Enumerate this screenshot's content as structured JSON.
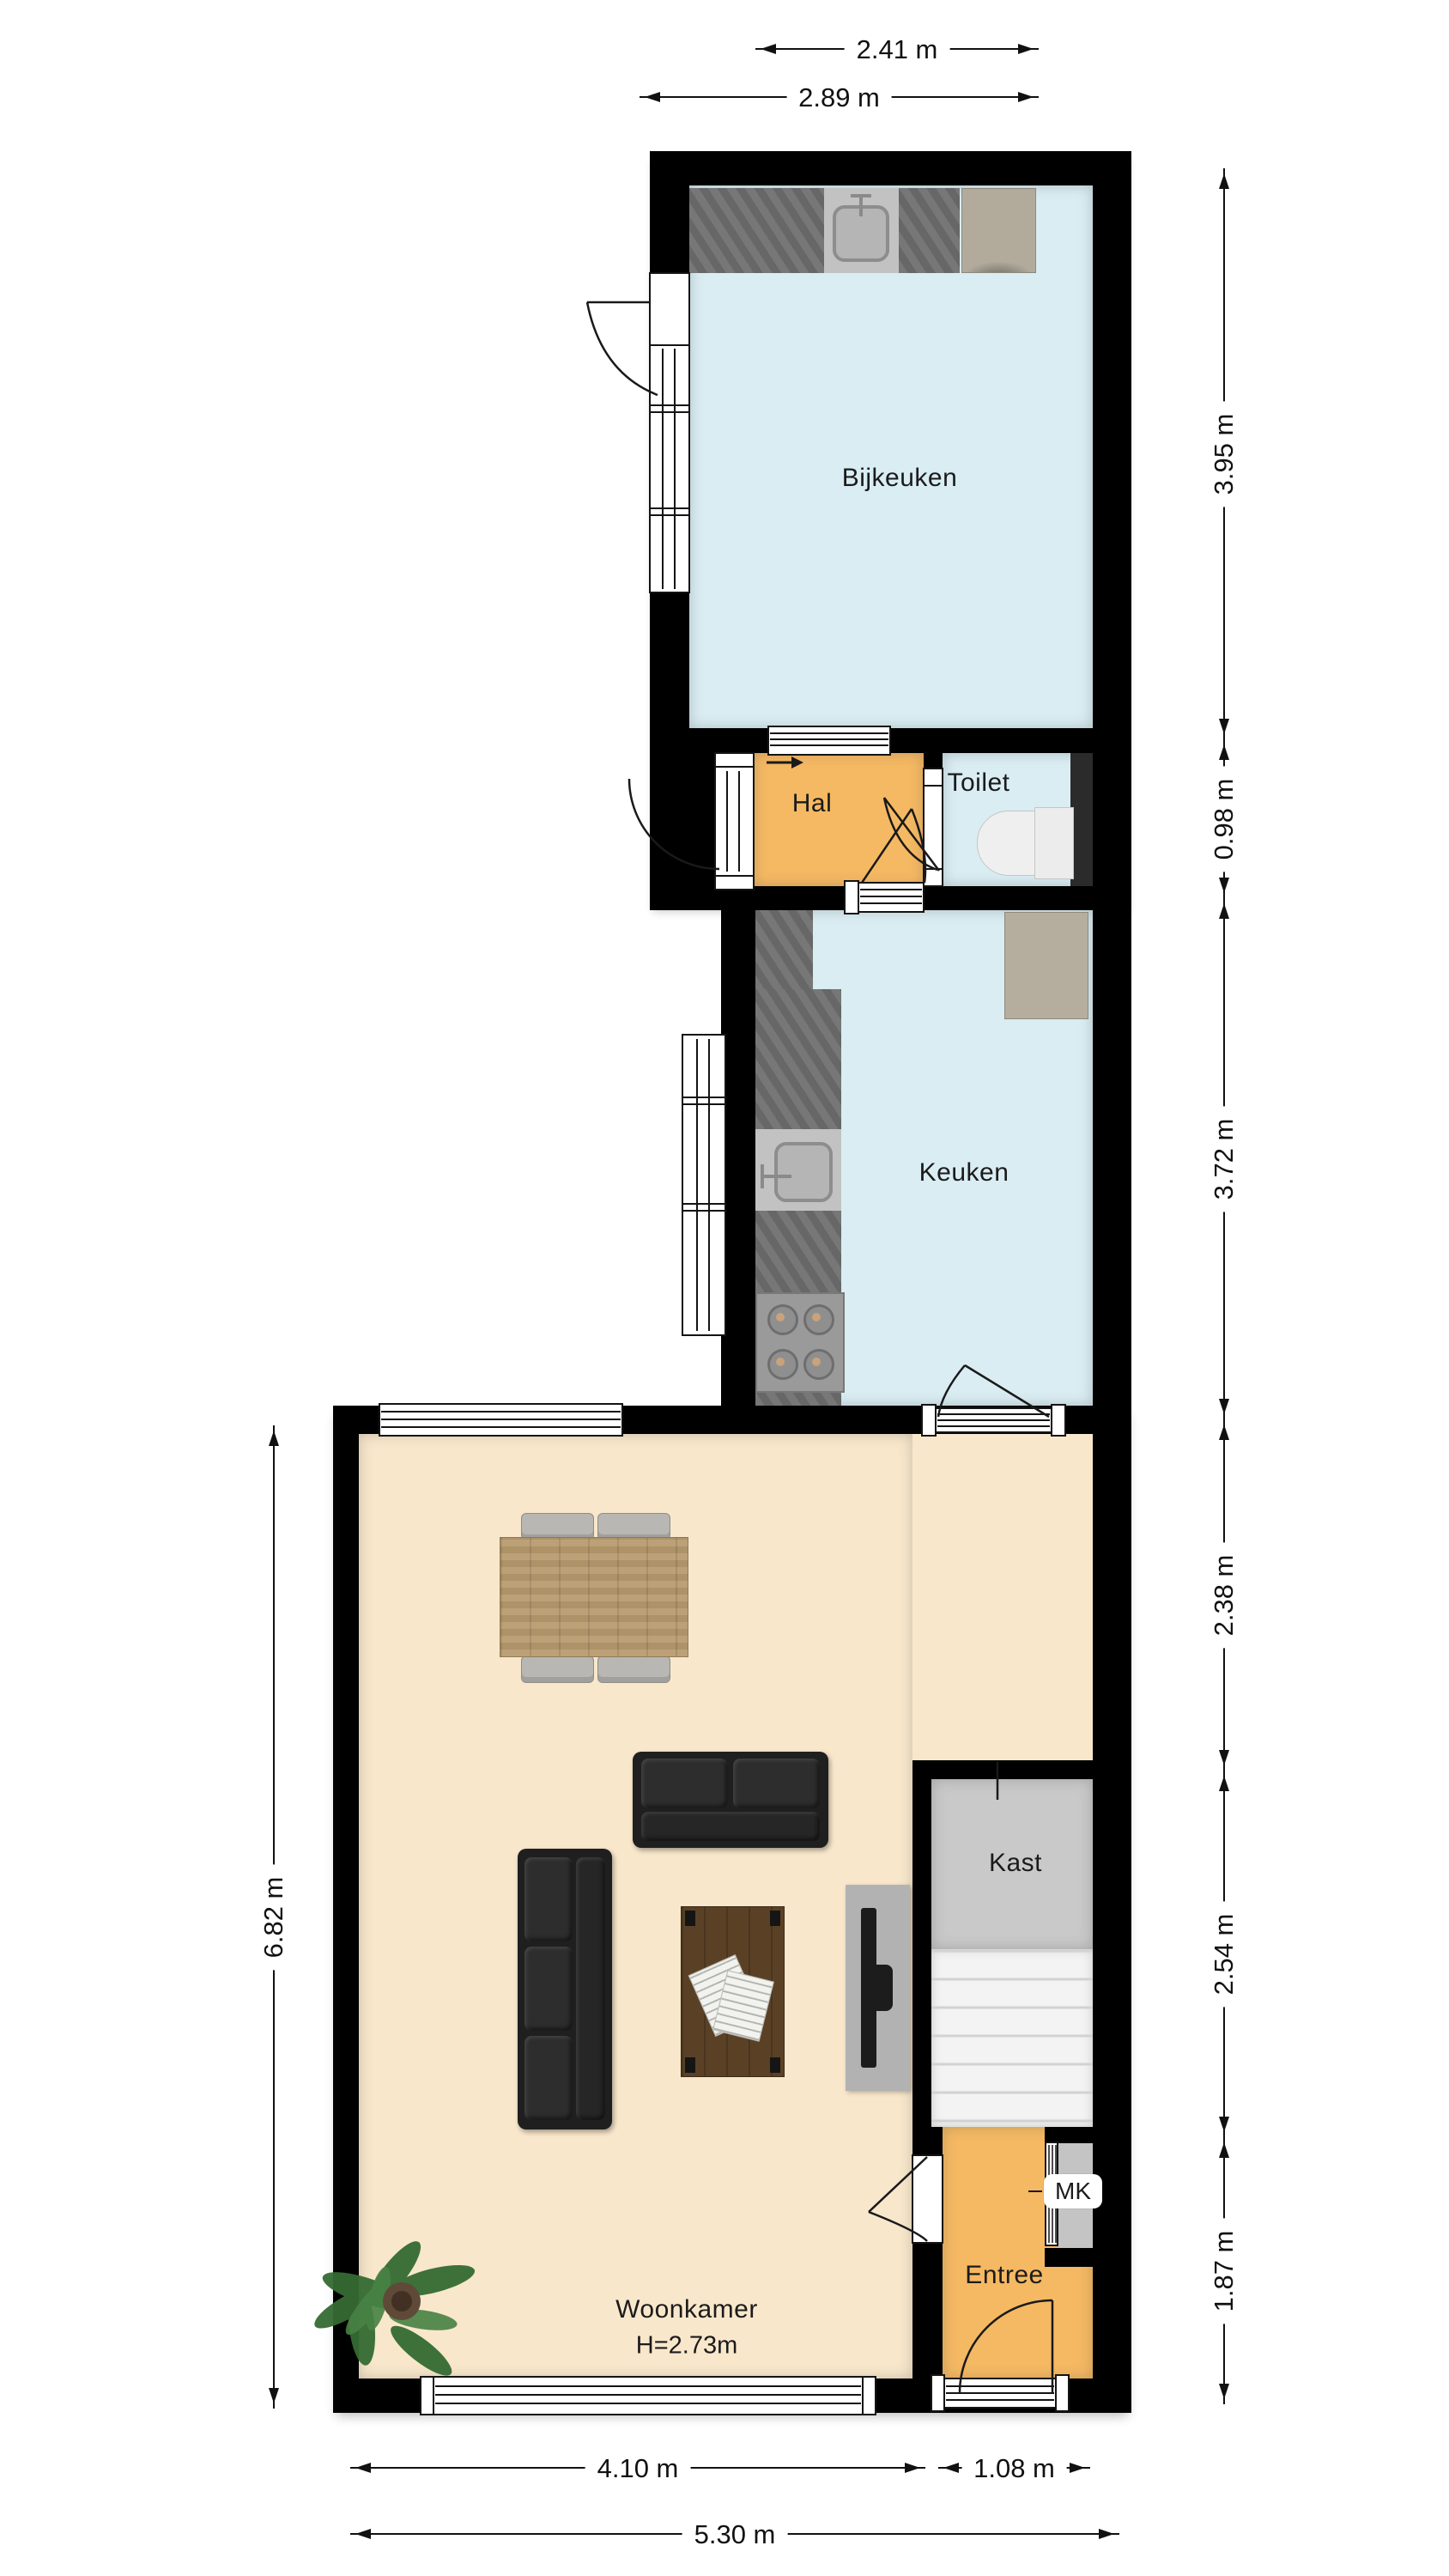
{
  "rooms": {
    "bijkeuken": {
      "label": "Bijkeuken"
    },
    "hal": {
      "label": "Hal"
    },
    "toilet": {
      "label": "Toilet"
    },
    "keuken": {
      "label": "Keuken"
    },
    "woonkamer": {
      "label": "Woonkamer",
      "ceiling_height": "H=2.73m"
    },
    "kast": {
      "label": "Kast"
    },
    "entree": {
      "label": "Entree"
    },
    "meterkast": {
      "label": "MK"
    }
  },
  "dimensions": {
    "top": [
      "2.41 m",
      "2.89 m"
    ],
    "right": [
      "3.95 m",
      "0.98 m",
      "3.72 m",
      "2.38 m",
      "2.54 m",
      "1.87 m"
    ],
    "left": [
      "6.82 m"
    ],
    "bottom": [
      "4.10 m",
      "1.08 m",
      "5.30 m"
    ]
  },
  "colors": {
    "wall_black": "#000000",
    "room_blue": "#d9edf3",
    "hall_orange": "#f5b963",
    "floor_beige": "#f8e7cb",
    "closet_gray": "#c9c9c9",
    "counter_gray": "#6f6f6f",
    "duct_dark": "#2b2b2b"
  }
}
